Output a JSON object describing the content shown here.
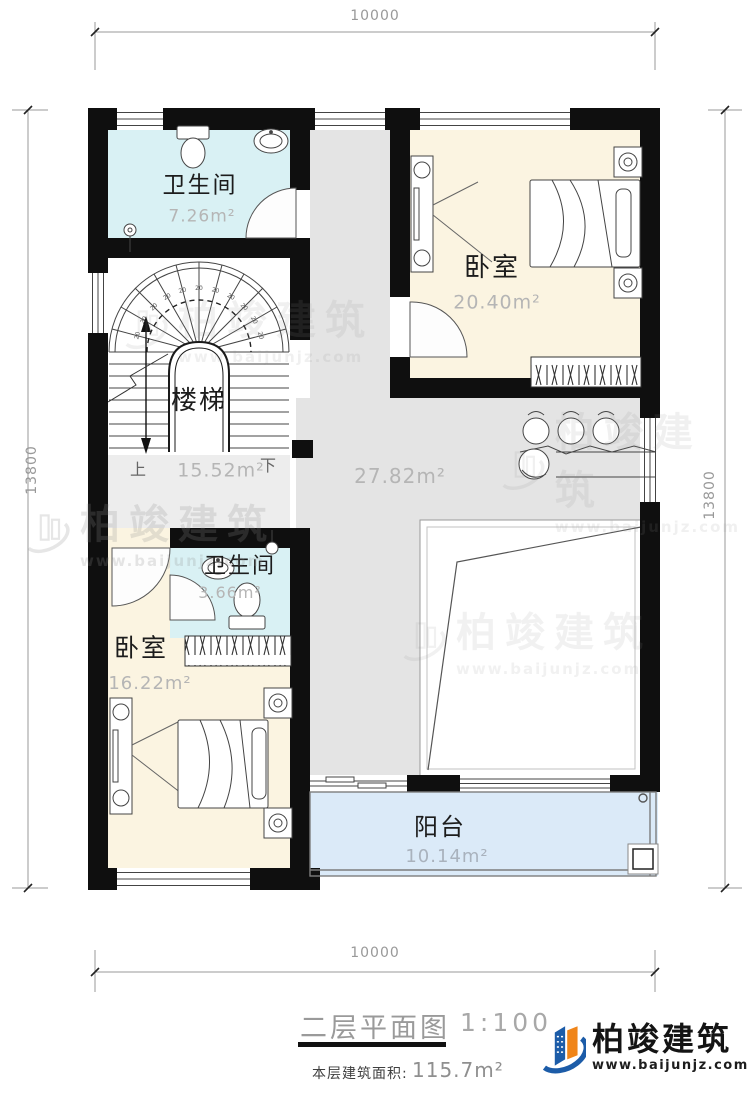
{
  "dims": {
    "top": "10000",
    "bottom": "10000",
    "left": "13800",
    "right": "13800"
  },
  "rooms": {
    "bath1": {
      "name": "卫生间",
      "area": "7.26m²"
    },
    "bed1": {
      "name": "卧室",
      "area": "20.40m²"
    },
    "stairs": {
      "name": "楼梯",
      "area": "15.52m²",
      "up": "上",
      "down": "下",
      "tread": "20"
    },
    "hall": {
      "area": "27.82m²"
    },
    "bath2": {
      "name": "卫生间",
      "area": "3.66m²"
    },
    "bed2": {
      "name": "卧室",
      "area": "16.22m²"
    },
    "balcony": {
      "name": "阳台",
      "area": "10.14m²"
    }
  },
  "titleblock": {
    "title": "二层平面图",
    "scale": "1:100",
    "area_label": "本层建筑面积:",
    "area_value": "115.7m²"
  },
  "brand": {
    "name": "柏竣建筑",
    "website": "www.baijunjz.com"
  },
  "watermark": {
    "name": "柏竣建筑",
    "website": "www.baijunjz.com"
  },
  "colors": {
    "bathroom": "#d9f1f4",
    "bedroom": "#fbf4e1",
    "hall": "#e4e4e4",
    "landing": "#ededed",
    "balcony": "#dbeaf8",
    "wall": "#0f0f0f",
    "brand_blue": "#1c5ca8",
    "brand_orange": "#f08519"
  }
}
